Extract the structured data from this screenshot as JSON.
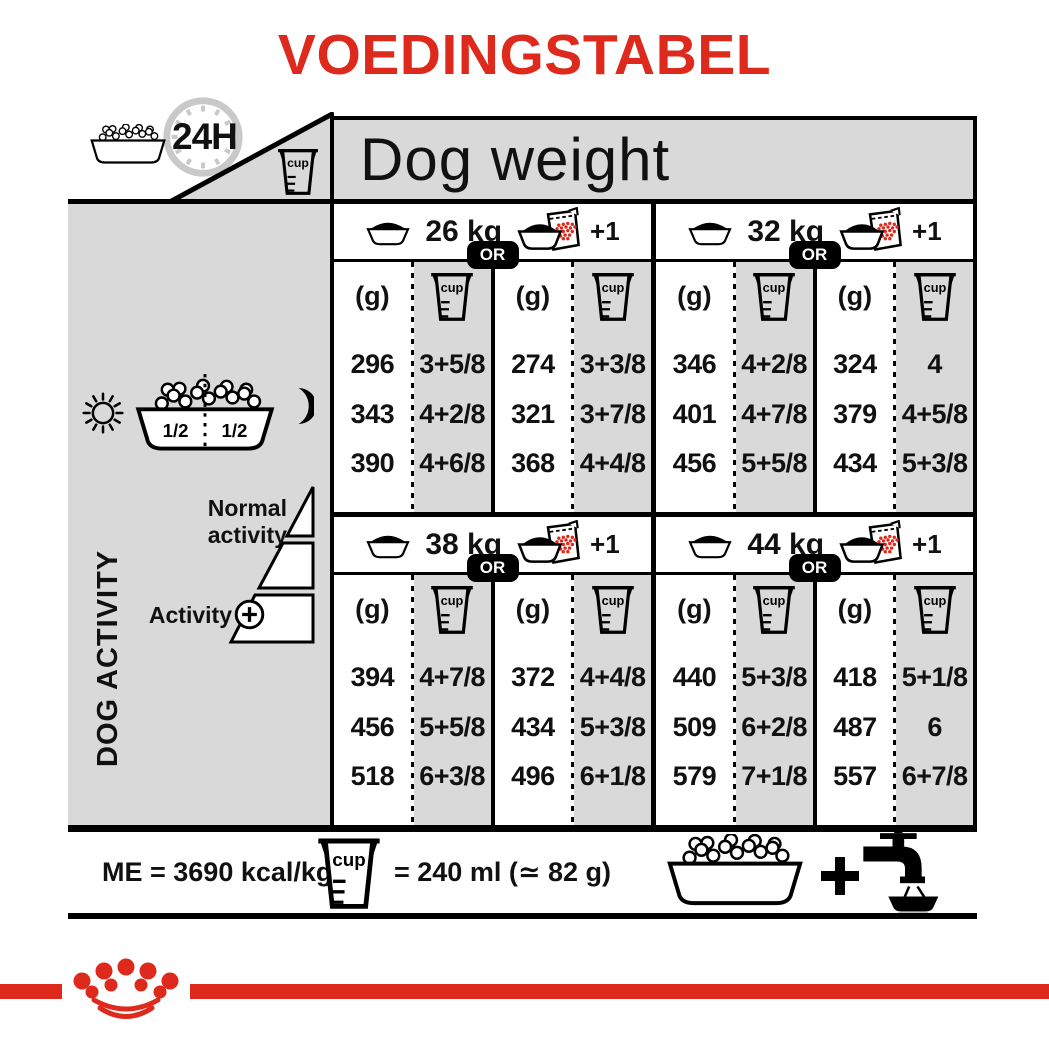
{
  "title": "VOEDINGSTABEL",
  "colors": {
    "red": "#dd2a1c",
    "gray": "#d9d9d9"
  },
  "header": {
    "hours": "24H",
    "dog_weight": "Dog weight"
  },
  "labels": {
    "cup": "cup",
    "g": "(g)",
    "or": "OR",
    "plus_one": "+1",
    "half": "1/2",
    "dog_activity": "DOG ACTIVITY",
    "normal_activity": "Normal activity",
    "activity": "Activity"
  },
  "sections": [
    {
      "weight": "26 kg",
      "bowl": {
        "g": [
          "296",
          "343",
          "390"
        ],
        "cups": [
          "3+5/8",
          "4+2/8",
          "4+6/8"
        ]
      },
      "pack": {
        "g": [
          "274",
          "321",
          "368"
        ],
        "cups": [
          "3+3/8",
          "3+7/8",
          "4+4/8"
        ]
      }
    },
    {
      "weight": "32 kg",
      "bowl": {
        "g": [
          "346",
          "401",
          "456"
        ],
        "cups": [
          "4+2/8",
          "4+7/8",
          "5+5/8"
        ]
      },
      "pack": {
        "g": [
          "324",
          "379",
          "434"
        ],
        "cups": [
          "4",
          "4+5/8",
          "5+3/8"
        ]
      }
    },
    {
      "weight": "38 kg",
      "bowl": {
        "g": [
          "394",
          "456",
          "518"
        ],
        "cups": [
          "4+7/8",
          "5+5/8",
          "6+3/8"
        ]
      },
      "pack": {
        "g": [
          "372",
          "434",
          "496"
        ],
        "cups": [
          "4+4/8",
          "5+3/8",
          "6+1/8"
        ]
      }
    },
    {
      "weight": "44 kg",
      "bowl": {
        "g": [
          "440",
          "509",
          "579"
        ],
        "cups": [
          "5+3/8",
          "6+2/8",
          "7+1/8"
        ]
      },
      "pack": {
        "g": [
          "418",
          "487",
          "557"
        ],
        "cups": [
          "5+1/8",
          "6",
          "6+7/8"
        ]
      }
    }
  ],
  "footer": {
    "me": "ME = 3690 kcal/kg",
    "cup_equiv": "= 240 ml (≃ 82 g)"
  }
}
